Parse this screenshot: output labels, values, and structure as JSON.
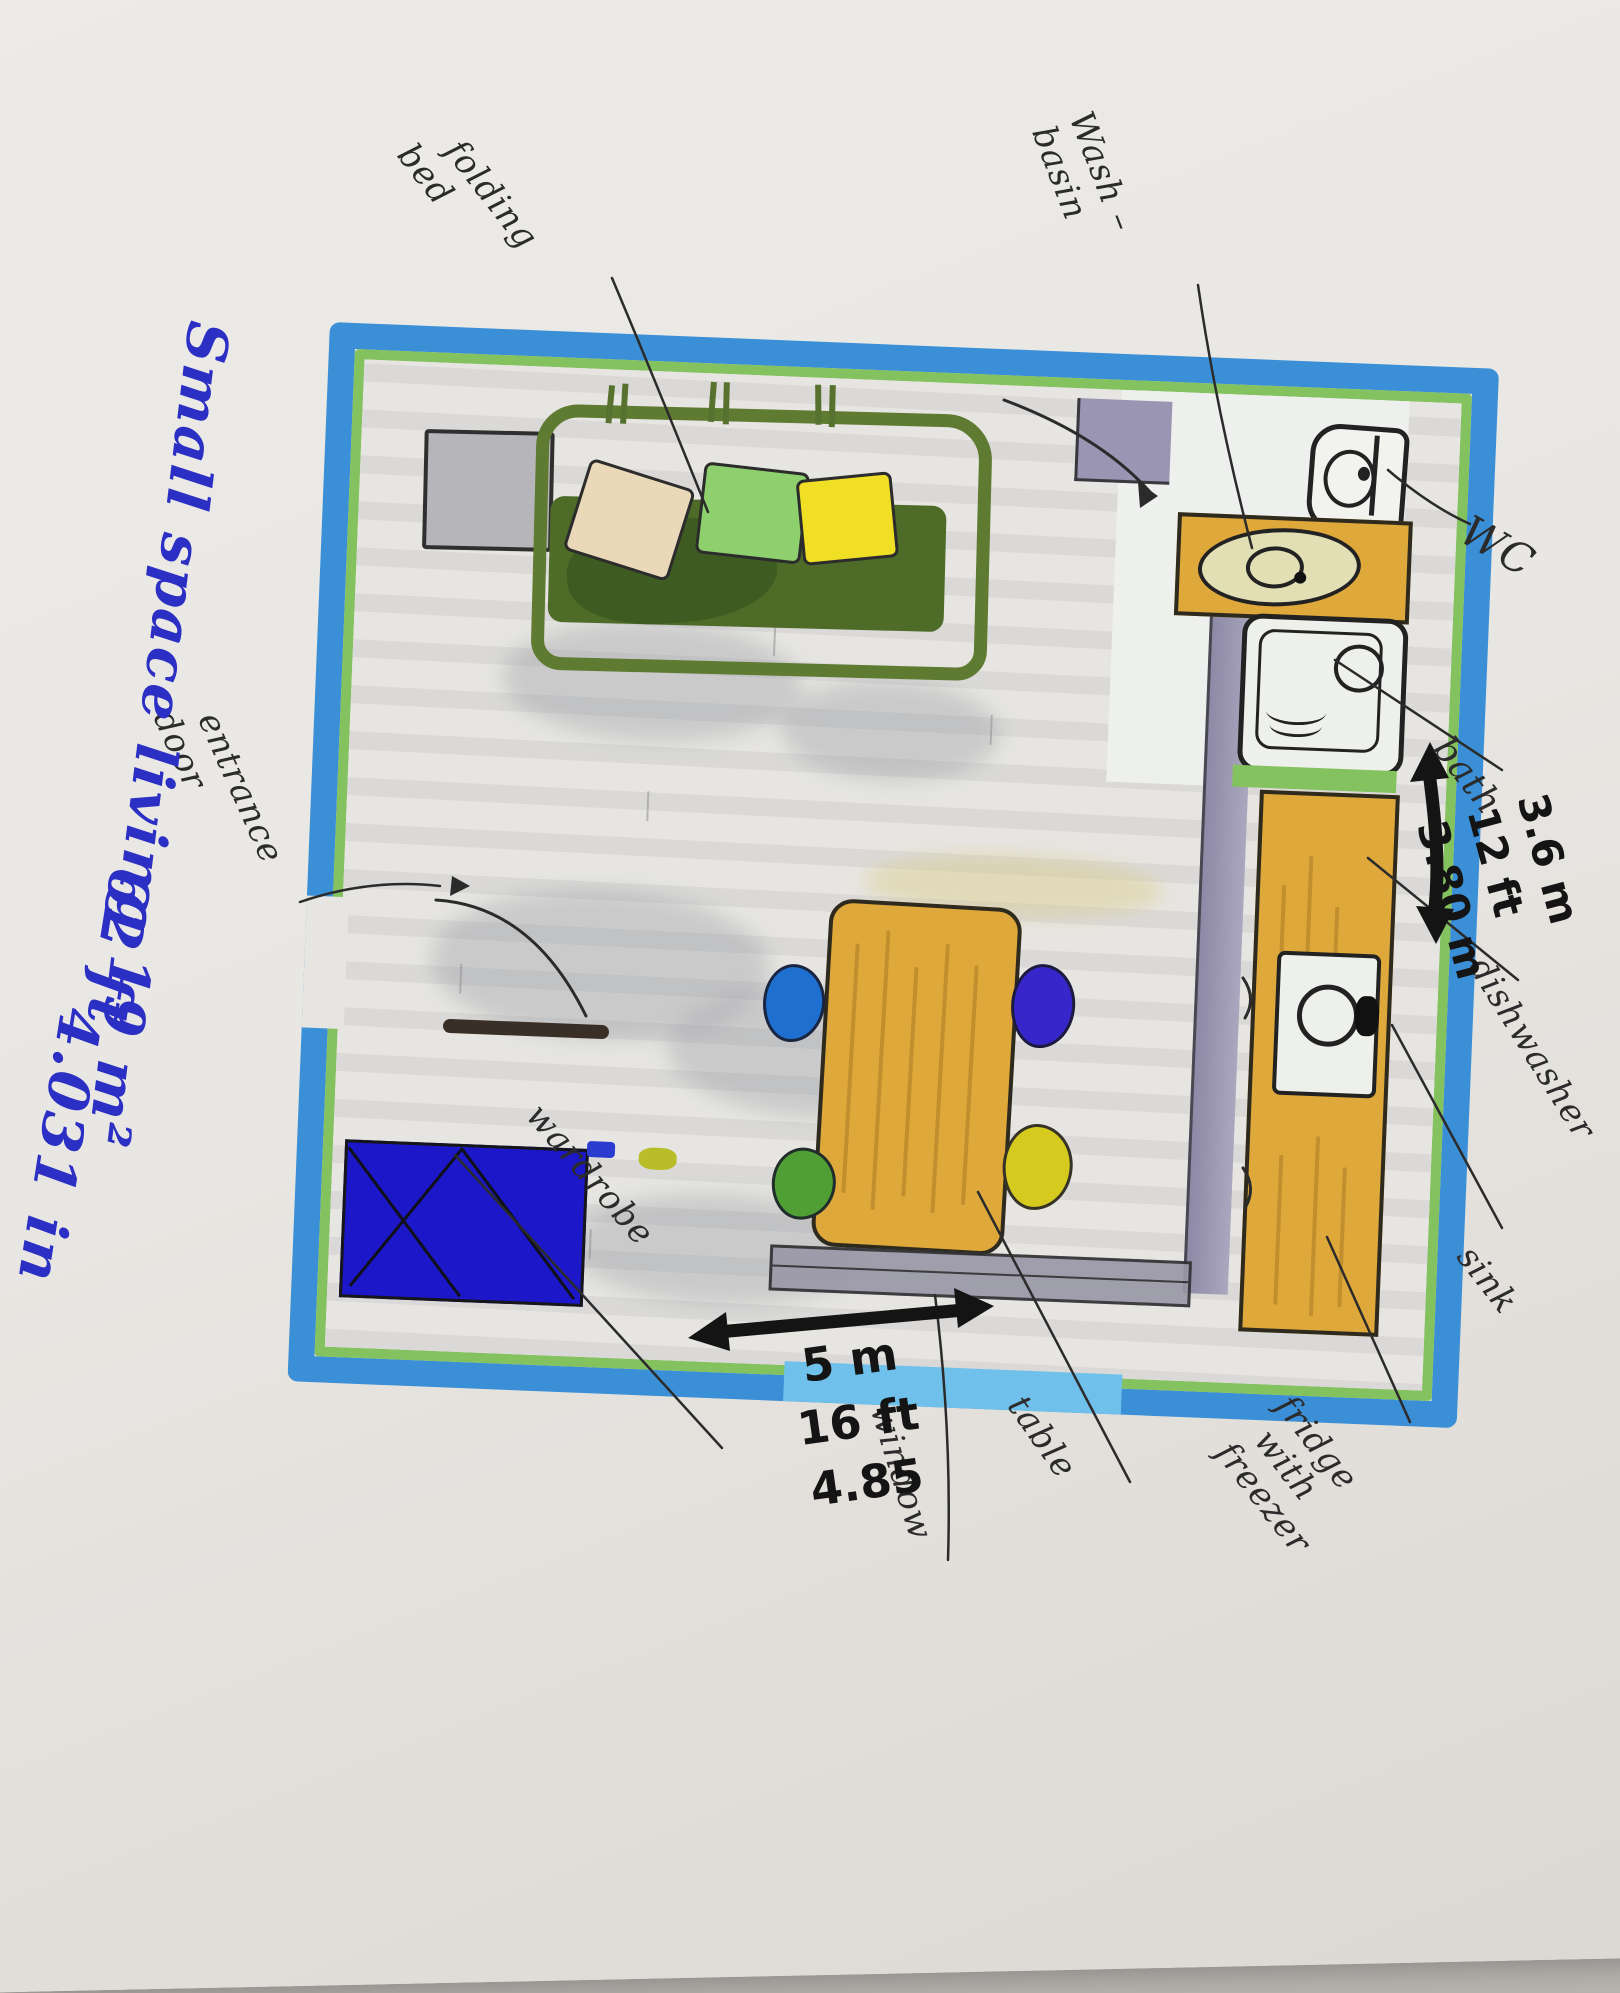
{
  "title": {
    "lines": [
      "Small space living 19 m²",
      "62 ft",
      "4.031 in"
    ]
  },
  "annotations": {
    "folding_bed": [
      "folding",
      "bed"
    ],
    "wash_basin": [
      "Wash –",
      "basin"
    ],
    "wc": "WC",
    "bath": "bath",
    "dishwasher": "dishwasher",
    "sink": "sink",
    "fridge": [
      "fridge",
      "with",
      "freezer"
    ],
    "table": "table",
    "window": "window",
    "wardrobe": "wardrobe",
    "entrance_door": [
      "entrance",
      "door"
    ]
  },
  "dimensions": {
    "right_wall": [
      "3.6 m",
      "12 ft",
      "3.80 m"
    ],
    "bottom_wall": [
      "5 m",
      "16 ft",
      "4.85"
    ]
  },
  "colors": {
    "wall-blue": "#3a8fd7",
    "inner-green": "#84c15f",
    "title-blue": "#2b2fc4",
    "wood": "#dfa83b",
    "wood-grain": "#b8872b",
    "wardrobe-blue": "#1c17c9",
    "sofa-frame": "#5f7a31",
    "sofa-cushion": "#4e6b28",
    "pillow-beige": "#e9d9b9",
    "pillow-green": "#8ed06d",
    "pillow-yellow": "#f0df25",
    "chair-teal": "#1f6fd0",
    "chair-indigo": "#3726c9",
    "chair-green": "#4f9f35",
    "chair-yellow": "#d6ca1e",
    "partition-purple": "#9a95b3",
    "window-gray": "#9b99a8",
    "window-glass": "#6fc0ea",
    "ink": "#2b2b2b",
    "floor": "#e6e5e1"
  }
}
